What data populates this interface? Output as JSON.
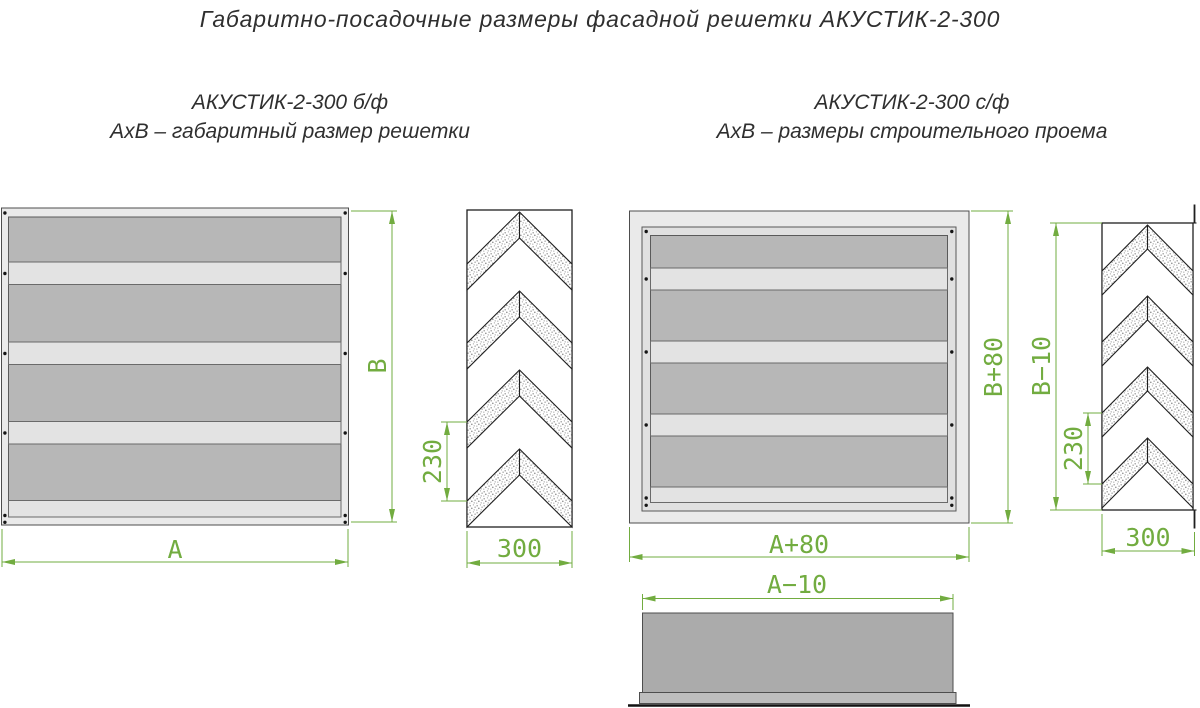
{
  "title": "Габаритно-посадочные размеры фасадной решетки АКУСТИК-2-300",
  "left_drawing": {
    "subtitle_line1": "АКУСТИК-2-300 б/ф",
    "subtitle_line2": "АхВ – габаритный размер решетки",
    "dims": {
      "width": "А",
      "height": "В",
      "louver_pitch": "230",
      "depth": "300"
    }
  },
  "right_drawing": {
    "subtitle_line1": "АКУСТИК-2-300 с/ф",
    "subtitle_line2": "АхВ – размеры строительного проема",
    "dims": {
      "width": "А+80",
      "height": "В+80",
      "side_height": "В−10",
      "louver_pitch": "230",
      "depth": "300",
      "bottom_width": "А−10"
    }
  },
  "colors": {
    "dimension_green": "#72ac40",
    "frame_gray": "#eaeaea",
    "panel_dark": "#b7b7b7",
    "panel_light": "#e3e3e3",
    "outline": "#1f1f1f"
  }
}
